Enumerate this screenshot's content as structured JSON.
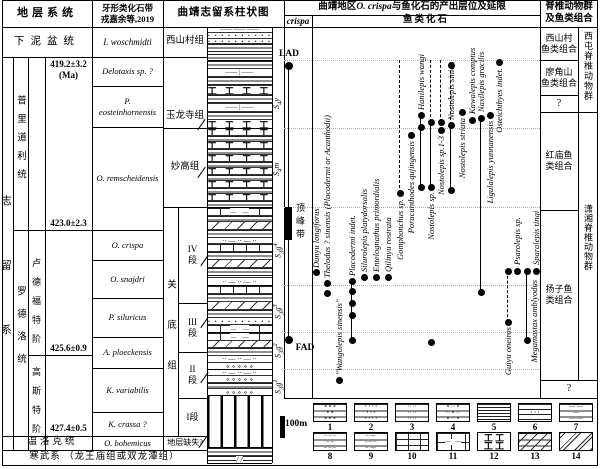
{
  "titles": {
    "strat_header": "地层系统",
    "conodont_header1": "牙形类化石带",
    "conodont_header2": "戎嘉余等,2019",
    "column_header": "曲靖志留系柱状图",
    "occurrence_header_pre": "曲靖地区",
    "occurrence_header_italic": "O. crispa",
    "occurrence_header_post": "与鱼化石的产出层位及延限",
    "crispa_sub": "crispa",
    "fish_sub": "鱼类化石",
    "fauna_header": "脊椎动物群\n及鱼类组合"
  },
  "strat": {
    "devonian": "下泥盆统",
    "silurian": "志留系",
    "pridoli": "普里道利统",
    "ludlow": "罗德洛统",
    "ludfordian": "卢德福特阶",
    "gorstian": "高斯特阶",
    "wenlock": "温洛克统",
    "cambrian": "寒武系  （龙王庙组或双龙潭组）",
    "age_top": "419.2±3.2\n(Ma)",
    "age_423": "423.0±2.3",
    "age_425": "425.6±0.9",
    "age_427": "427.4±0.5"
  },
  "conodont_zones": [
    "I. woschmidti",
    "Delotaxis sp. ?",
    "P. eosteinhornensis",
    "O. remscheidensis",
    "O. crispa",
    "O. snajdri",
    "P. siluricus",
    "A. ploeckensis",
    "K. variabilis",
    "K. crassa ?",
    "O. bohemicus"
  ],
  "formations": {
    "xishancun": "西山村组",
    "yulongsi": "玉龙寺组",
    "miaogao": "妙高组",
    "guandi": "关底组",
    "member4": "IV段",
    "member3": "III段",
    "member2": "II段",
    "member1": "I段",
    "missing": "地层缺失?"
  },
  "unit_codes": [
    {
      "code": "S4y",
      "y": 97
    },
    {
      "code": "S4m",
      "y": 164
    },
    {
      "code": "S3g4",
      "y": 246
    },
    {
      "code": "S3g3",
      "y": 307
    },
    {
      "code": "S3g2",
      "y": 346
    },
    {
      "code": "S3g1",
      "y": 382
    }
  ],
  "crispa": {
    "lad": "LAD",
    "fad": "FAD",
    "acme": "顶峰带",
    "lad_y": 66,
    "fad_y": 340,
    "acme_top": 207,
    "acme_bottom": 240
  },
  "scale_label": "100m",
  "fish_chart": {
    "gridlines": [
      60,
      128,
      207,
      285,
      332,
      369
    ]
  },
  "fish_species": [
    {
      "name": "Dunyu longiforus",
      "x": 316,
      "label_anchor": "above",
      "label_y": 268,
      "dots": [
        272
      ]
    },
    {
      "name": "Thelodus ? sinensis (Placodermi or Acanthodii)",
      "x": 327,
      "label_anchor": "above",
      "label_y": 278,
      "dots": [
        283,
        293
      ]
    },
    {
      "name": "\"Wangolepis sinensis\"",
      "x": 339,
      "label_anchor": "above",
      "label_y": 375,
      "dots": [
        380
      ]
    },
    {
      "name": "Placodermi indet.",
      "x": 352,
      "label_anchor": "above",
      "label_y": 276,
      "dots": [
        281,
        291,
        303,
        315,
        340
      ],
      "line": [
        281,
        340
      ]
    },
    {
      "name": "Silurolepis platydorsalis",
      "x": 364,
      "label_anchor": "above",
      "label_y": 272,
      "dots": [
        277
      ]
    },
    {
      "name": "Entelognathus primordialis",
      "x": 376,
      "label_anchor": "above",
      "label_y": 272,
      "dots": [
        277
      ]
    },
    {
      "name": "Qilinyu rostrata",
      "x": 388,
      "label_anchor": "above",
      "label_y": 272,
      "dots": [
        277
      ]
    },
    {
      "name": "Gomphonchus sp.",
      "x": 400,
      "label_anchor": "below",
      "label_y": 199,
      "dots": [
        193
      ],
      "dash": [
        60,
        193
      ]
    },
    {
      "name": "Poracanthodes qujingensis",
      "x": 411,
      "label_anchor": "below",
      "label_y": 141,
      "dots": [
        135
      ]
    },
    {
      "name": "Hanilepis wangi",
      "x": 421,
      "label_anchor": "above",
      "label_y": 110,
      "dots": [
        115,
        127,
        187
      ],
      "line": [
        115,
        187
      ]
    },
    {
      "name": "Nostolepis sp.",
      "x": 431,
      "label_anchor": "below",
      "label_y": 192,
      "dots": [
        122,
        187,
        342
      ],
      "line": [
        122,
        187
      ],
      "dash": [
        60,
        122
      ]
    },
    {
      "name": "Nostolepis sp.1-3",
      "x": 441,
      "label_anchor": "below",
      "label_y": 136,
      "dots": [
        122,
        130
      ],
      "dash": [
        60,
        122
      ]
    },
    {
      "name": "Nostolepis sinica",
      "x": 451,
      "label_anchor": "above",
      "label_y": 120,
      "dots": [
        65,
        125,
        190
      ],
      "line": [
        125,
        190
      ],
      "dash": [
        65,
        125
      ]
    },
    {
      "name": "Nostolepis striata",
      "x": 462,
      "label_anchor": "below",
      "label_y": 118,
      "dots": [
        112
      ]
    },
    {
      "name": "Kawalepis comptus",
      "x": 472,
      "label_anchor": "above",
      "label_y": 114,
      "dots": [
        120
      ]
    },
    {
      "name": "Naxilepis gracilis",
      "x": 481,
      "label_anchor": "above",
      "label_y": 112,
      "dots": [
        118,
        292
      ],
      "line": [
        118,
        292
      ]
    },
    {
      "name": "Ligulalepis yunnanensis",
      "x": 490,
      "label_anchor": "below",
      "label_y": 121,
      "dots": [
        115
      ]
    },
    {
      "name": "Osteichthyes indet.",
      "x": 499,
      "label_anchor": "below",
      "label_y": 68,
      "dots": [
        62
      ]
    },
    {
      "name": "Guiyu oneiros",
      "x": 508,
      "label_anchor": "below",
      "label_y": 327,
      "dots": [
        271,
        322
      ],
      "dash": [
        271,
        322
      ]
    },
    {
      "name": "Psarolepis sp.",
      "x": 517,
      "label_anchor": "above",
      "label_y": 265,
      "dots": [
        271
      ]
    },
    {
      "name": "Megamastax amblyodus",
      "x": 527,
      "label_anchor": "below",
      "label_y": 280,
      "label_dx": 7,
      "dots": [
        271,
        340
      ],
      "line": [
        271,
        340
      ]
    },
    {
      "name": "Sparalepis tingi",
      "x": 536,
      "label_anchor": "above",
      "label_y": 265,
      "dots": [
        271
      ]
    }
  ],
  "assemblages": {
    "xishancun": "西山村\n鱼类组合",
    "liaojiaoshan": "廖角山\n鱼类组合",
    "q1": "?",
    "hongmiao": "红庙鱼\n类组合",
    "yangzi": "扬子鱼\n类组合",
    "q2": "?",
    "xitun": "西屯脊椎动物群",
    "xiaoxiang": "潇湘脊椎动物群"
  },
  "lithology": {
    "units": [
      {
        "name": "xishancun",
        "top": 27,
        "beds": [
          [
            5,
            "dash"
          ],
          [
            6,
            "dots"
          ],
          [
            5,
            "dots"
          ],
          [
            17,
            "lines"
          ]
        ]
      },
      {
        "name": "yulongsi",
        "top": 60,
        "beds": [
          [
            8,
            "lines"
          ],
          [
            8,
            "dashbox"
          ],
          [
            9,
            "lines"
          ],
          [
            9,
            "ibeam"
          ],
          [
            9,
            "lines"
          ],
          [
            8,
            "dashbox"
          ],
          [
            8,
            "lines"
          ],
          [
            9,
            "ibeam"
          ]
        ]
      },
      {
        "name": "miaogao",
        "top": 128,
        "beds": [
          [
            7,
            "ibeam"
          ],
          [
            6,
            "lines"
          ],
          [
            7,
            "ibeam"
          ],
          [
            6,
            "lines"
          ],
          [
            7,
            "ibeam"
          ],
          [
            6,
            "lines"
          ],
          [
            7,
            "ibeam"
          ],
          [
            6,
            "lines"
          ],
          [
            7,
            "ibeam"
          ],
          [
            6,
            "lines"
          ],
          [
            7,
            "ibeam"
          ],
          [
            7,
            "lines"
          ]
        ]
      },
      {
        "name": "guandi-4",
        "top": 207,
        "beds": [
          [
            8,
            "brickdash"
          ],
          [
            6,
            "lines"
          ],
          [
            8,
            "diag"
          ],
          [
            8,
            "lines"
          ],
          [
            6,
            "dashdot"
          ],
          [
            8,
            "brick"
          ],
          [
            8,
            "lines"
          ],
          [
            8,
            "diag"
          ],
          [
            10,
            "lines"
          ],
          [
            8,
            "dashdot"
          ]
        ]
      },
      {
        "name": "guandi-3",
        "top": 285,
        "beds": [
          [
            8,
            "brick"
          ],
          [
            8,
            "lines"
          ],
          [
            8,
            "diag"
          ],
          [
            8,
            "lines"
          ],
          [
            7,
            "dots"
          ],
          [
            8,
            "brickdash"
          ]
        ]
      },
      {
        "name": "guandi-2",
        "top": 332,
        "beds": [
          [
            8,
            "brickdash"
          ],
          [
            7,
            "diag"
          ],
          [
            8,
            "lines"
          ],
          [
            7,
            "dashdot"
          ],
          [
            7,
            "circ"
          ]
        ]
      },
      {
        "name": "guandi-1",
        "top": 369,
        "beds": [
          [
            6,
            "dashdot"
          ],
          [
            7,
            "circ"
          ],
          [
            6,
            "lines"
          ],
          [
            7,
            "circ"
          ]
        ]
      },
      {
        "name": "missing",
        "top": 395,
        "beds": [
          [
            52,
            "vstripe"
          ]
        ]
      },
      {
        "name": "cambrian",
        "top": 447,
        "beds": [
          [
            8,
            "lines"
          ],
          [
            8,
            "diagdash"
          ]
        ]
      }
    ]
  },
  "legend_items": [
    {
      "n": "1",
      "icon": "circles-lines",
      "cls": "lp1 lgl"
    },
    {
      "n": "2",
      "icon": "dots-lines",
      "cls": "lp2 lgl"
    },
    {
      "n": "3",
      "icon": "dash-dots",
      "cls": "lp3 lgl"
    },
    {
      "n": "4",
      "icon": "circle-dash",
      "cls": "lp4 lgl"
    },
    {
      "n": "5",
      "icon": "shale-lines",
      "cls": "lp5"
    },
    {
      "n": "6",
      "icon": "silty-shale",
      "cls": "lp6"
    },
    {
      "n": "7",
      "icon": "dash-pairs",
      "cls": "lp7 lgl"
    },
    {
      "n": "8",
      "icon": "short-dashes",
      "cls": "lp8 lgl"
    },
    {
      "n": "9",
      "icon": "dash-hooks",
      "cls": "lp9 lgl"
    },
    {
      "n": "10",
      "icon": "limestone-brick",
      "cls": "lp10"
    },
    {
      "n": "11",
      "icon": "argillaceous-limestone",
      "cls": "lp11"
    },
    {
      "n": "12",
      "icon": "bioclastic-limestone",
      "cls": "lp12"
    },
    {
      "n": "13",
      "icon": "diagonal-dash",
      "cls": "lp13"
    },
    {
      "n": "14",
      "icon": "double-diagonal",
      "cls": "lp14"
    }
  ]
}
